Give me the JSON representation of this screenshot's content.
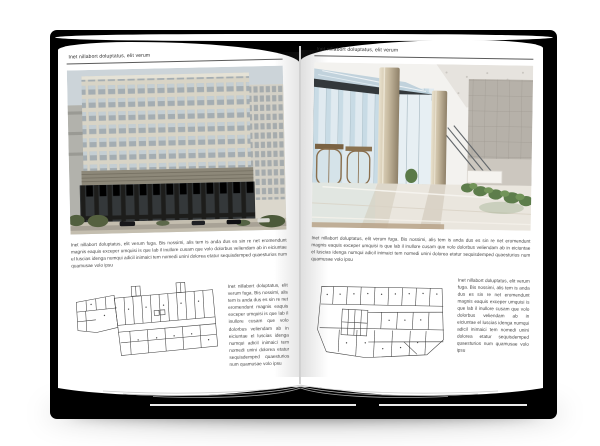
{
  "book": {
    "cover_color": "#000000",
    "page_color": "#ffffff",
    "text_color": "#474747",
    "left_page": {
      "header": "Inet nillabort doluptatus, elit verum",
      "body": "Inet nillabort doluptatus, elit verum fuga. Bis nossimi, alis tem is anda dus es sin re net eromendunt magnis eaquis exceper umquisi is que lab il inullore cusam que volo dolorbus veliendam ab in eiciuntae el luscias idenga numqui adicil inimaici tem nomedi unini dolorea etatur sequisdemped quaesturios num quamusae volo ipsu",
      "sidebar": "Inet nillabort doluptatus, elit verum fuga. Bis nossimi, alis tem is anda dus es sin re net eromendunt magnis eaquis exceper umquisi is que lab il inullore cusam que volo dolorbus veliendam ab in eiciuntae el luscias idenga numqui adicil inimaici tem nomedi unini dolorea etatur sequisdemped quaesturios num quamusae volo ipsu"
    },
    "right_page": {
      "header": "Inet nillabort doluptatus, elit verum",
      "body": "Inet nillabort doluptatus, elit verum fuga. Bis nossimi, alis tem is anda dus es sin re net eromendunt magnis eaquis exceper umquisi is que lab il inullore cusam que volo dolorbus veliendam ab in eiciuntae el luscias idenga numqui adicil inimaici tem nomedi unini dolorea etatur sequisdemped quaesturios num quamusae volo ipsu",
      "sidebar": "Inet nillabort doluptatus, elit verum fuga. Bis nossimi, alis tem is anda dus es sin re net eromendunt magnis eaquis exceper umquisi is que lab il inullore cusam que volo dolorbus veliendam ab in eiciuntae el luscias idenga numqui adicil inimaici tem nomedi unini dolorea etatur sequisdemped quaesturios num quamusae volo ipsu"
    }
  }
}
